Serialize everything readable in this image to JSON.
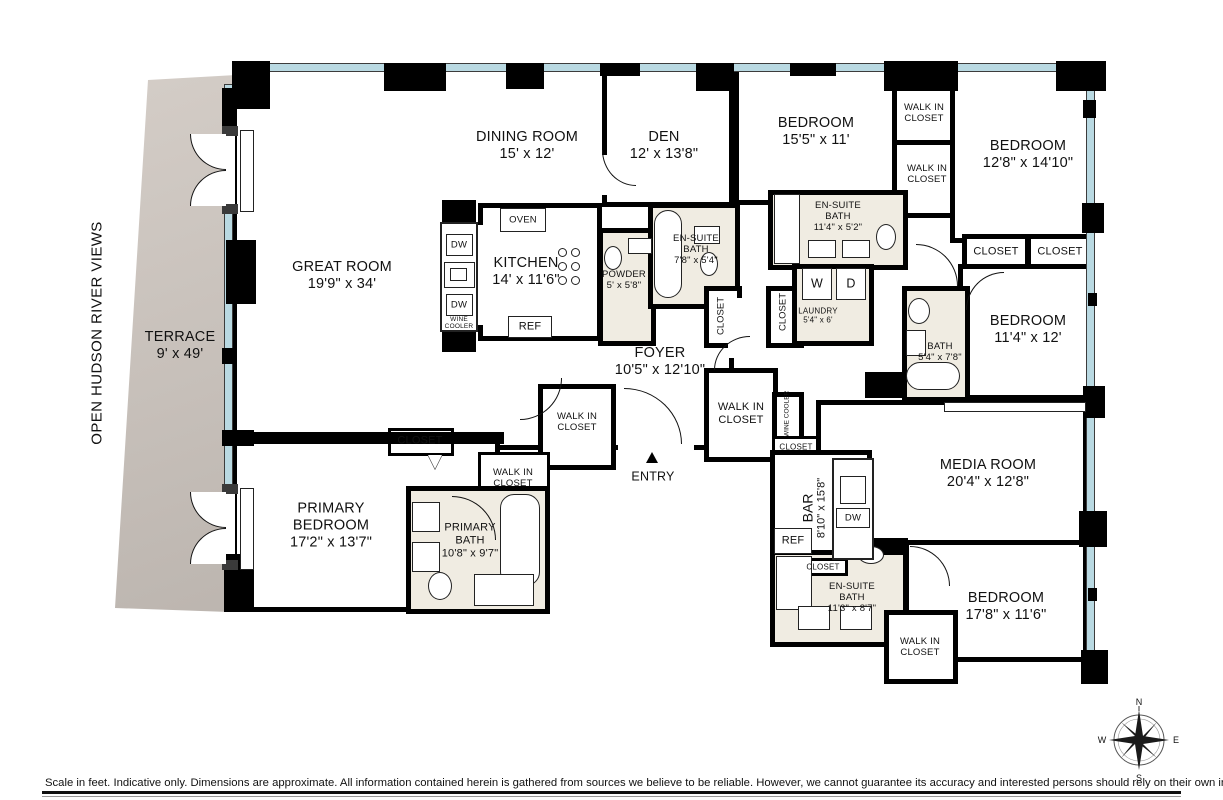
{
  "meta": {
    "orientation_label": "OPEN HUDSON RIVER VIEWS",
    "disclaimer": "Scale in feet. Indicative only. Dimensions are approximate. All information contained herein is gathered from sources we believe to be reliable. However, we cannot guarantee its accuracy and interested persons should rely on their own  inquiries .",
    "compass": {
      "north": "N",
      "south": "S",
      "east": "E",
      "west": "W"
    }
  },
  "rooms": {
    "terrace": {
      "name": "TERRACE",
      "dims": "9' x 49'"
    },
    "great_room": {
      "name": "GREAT ROOM",
      "dims": "19'9\" x 34'"
    },
    "dining_room": {
      "name": "DINING ROOM",
      "dims": "15' x 12'"
    },
    "den": {
      "name": "DEN",
      "dims": "12' x 13'8\""
    },
    "kitchen": {
      "name": "KITCHEN",
      "dims": "14' x 11'6\""
    },
    "powder": {
      "name": "POWDER",
      "dims": "5' x 5'8\""
    },
    "ensuite_bath_den": {
      "name": "EN-SUITE BATH",
      "dims": "7'8\" x 5'4\""
    },
    "bedroom_1": {
      "name": "BEDROOM",
      "dims": "15'5\" x 11'"
    },
    "bedroom_2": {
      "name": "BEDROOM",
      "dims": "12'8\" x 14'10\""
    },
    "ensuite_bath_2": {
      "name": "EN-SUITE BATH",
      "dims": "11'4\" x 5'2\""
    },
    "laundry": {
      "name": "LAUNDRY",
      "dims": "5'4\" x 6'"
    },
    "bedroom_3": {
      "name": "BEDROOM",
      "dims": "11'4\" x 12'"
    },
    "bath_3": {
      "name": "BATH",
      "dims": "5'4\" x 7'8\""
    },
    "foyer": {
      "name": "FOYER",
      "dims": "10'5\" x 12'10\""
    },
    "primary_bedroom": {
      "name": "PRIMARY BEDROOM",
      "dims": "17'2\" x 13'7\""
    },
    "primary_bath": {
      "name": "PRIMARY BATH",
      "dims": "10'8\" x 9'7\""
    },
    "media_room": {
      "name": "MEDIA ROOM",
      "dims": "20'4\" x 12'8\""
    },
    "bar": {
      "name": "BAR",
      "dims": "8'10\" x 15'8\""
    },
    "ensuite_bath_4": {
      "name": "EN-SUITE BATH",
      "dims": "11'3\" x 8'7\""
    },
    "bedroom_4": {
      "name": "BEDROOM",
      "dims": "17'8\" x 11'6\""
    }
  },
  "labels": {
    "walk_in_closet": "WALK IN CLOSET",
    "closet": "CLOSET",
    "entry": "ENTRY",
    "oven": "OVEN",
    "ref": "REF",
    "dw": "DW",
    "wine_cooler": "WINE COOLER",
    "washer": "W",
    "dryer": "D"
  }
}
